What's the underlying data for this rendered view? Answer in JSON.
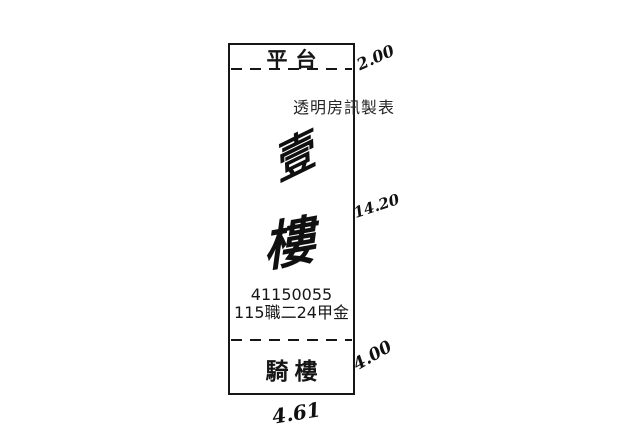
{
  "diagram": {
    "top_section_label": "平台",
    "bottom_section_label": "騎樓",
    "watermark": "透明房訊製表",
    "floor_handwritten": {
      "char1": "壹",
      "char2": "樓"
    },
    "property_id": "41150055",
    "lot_code": "115職二24甲金",
    "dimensions": {
      "top_right": "2.00",
      "middle_right": "14.20",
      "bottom_right": "4.00",
      "bottom_width": "4.61"
    },
    "colors": {
      "ink": "#161616",
      "background": "#ffffff"
    }
  }
}
